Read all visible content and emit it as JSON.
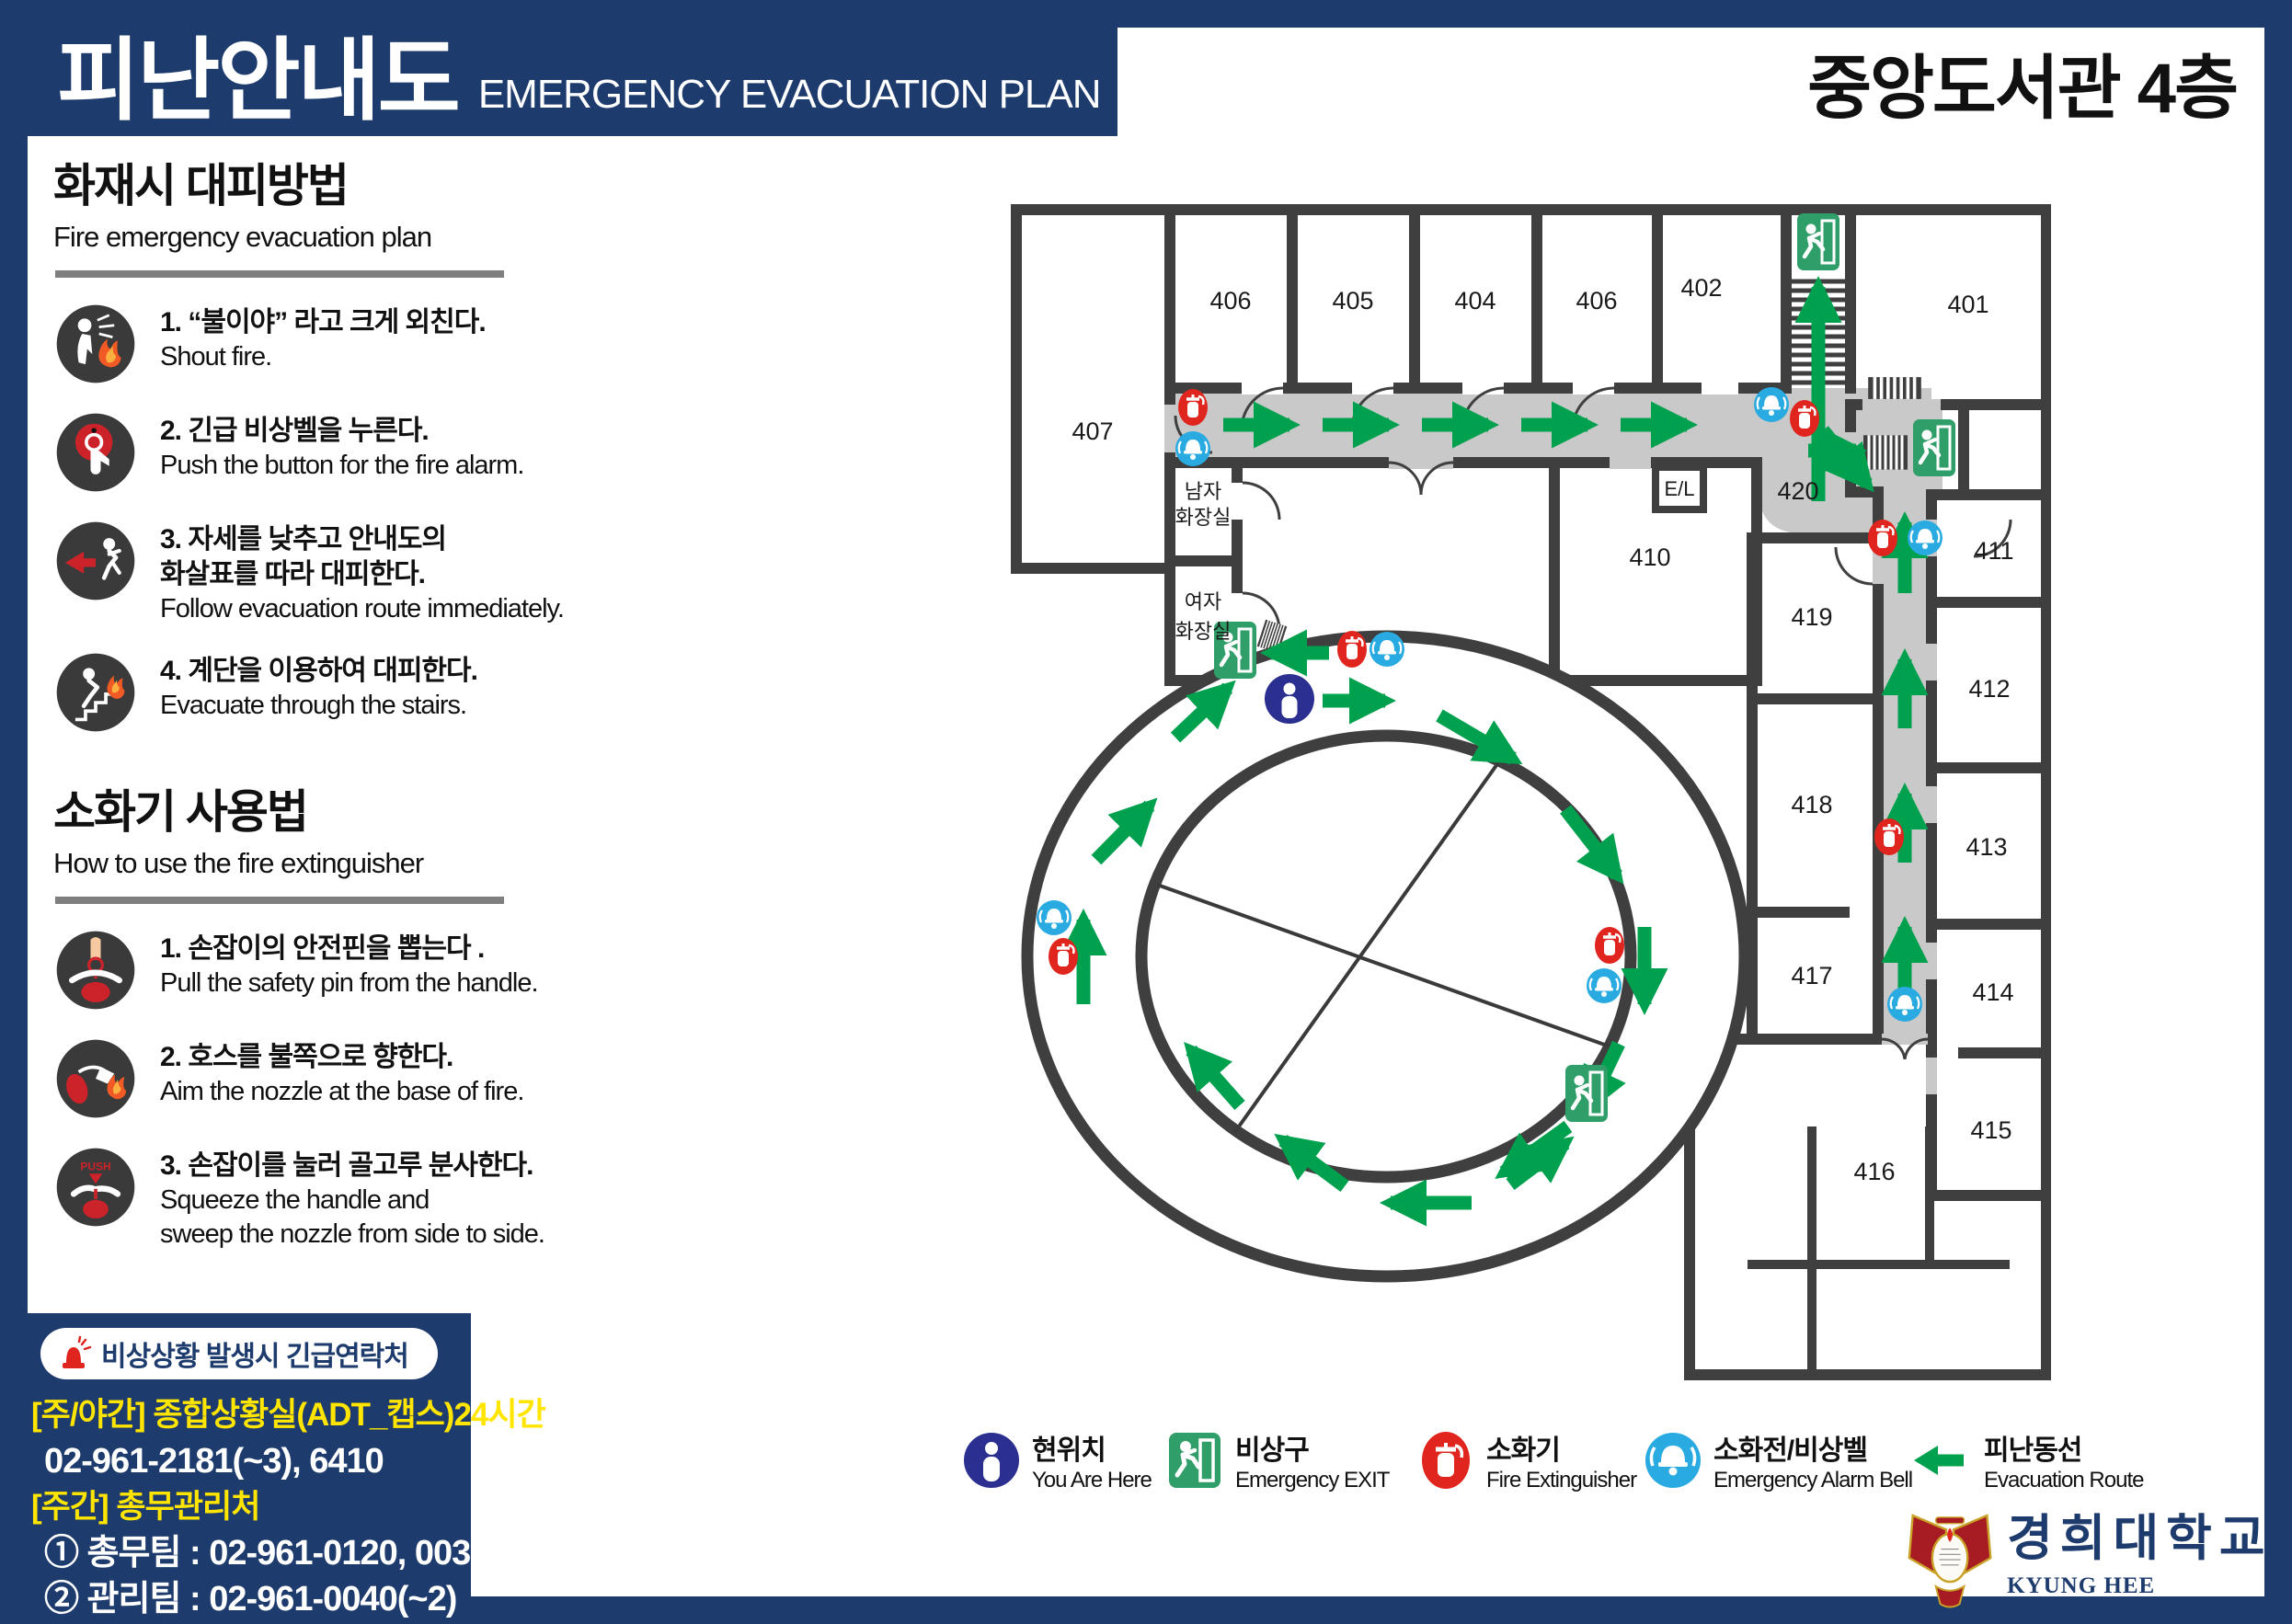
{
  "header": {
    "title_ko": "피난안내도",
    "title_en": "EMERGENCY EVACUATION PLAN",
    "location_title": "중앙도서관 4층"
  },
  "sidebar": {
    "fire": {
      "title_ko": "화재시 대피방법",
      "title_en": "Fire emergency evacuation plan",
      "steps": [
        {
          "icon": "shout-fire-icon",
          "ko_lines": [
            "1. “불이야” 라고 크게 외친다."
          ],
          "en_lines": [
            "Shout fire."
          ]
        },
        {
          "icon": "alarm-button-icon",
          "ko_lines": [
            "2. 긴급 비상벨을 누른다."
          ],
          "en_lines": [
            "Push the button for the fire alarm."
          ]
        },
        {
          "icon": "follow-route-icon",
          "ko_lines": [
            "3. 자세를 낮추고 안내도의",
            "화살표를 따라 대피한다."
          ],
          "en_lines": [
            "Follow evacuation route immediately."
          ]
        },
        {
          "icon": "stairs-evacuation-icon",
          "ko_lines": [
            "4. 계단을 이용하여 대피한다."
          ],
          "en_lines": [
            "Evacuate through the stairs."
          ]
        }
      ]
    },
    "extinguisher": {
      "title_ko": "소화기 사용법",
      "title_en": "How to use the fire extinguisher",
      "steps": [
        {
          "icon": "pull-pin-icon",
          "ko_lines": [
            "1. 손잡이의 안전핀을 뽑는다 ."
          ],
          "en_lines": [
            "Pull the safety pin from the handle."
          ]
        },
        {
          "icon": "aim-nozzle-icon",
          "ko_lines": [
            "2. 호스를 불쪽으로 향한다."
          ],
          "en_lines": [
            "Aim the nozzle at the base of fire."
          ]
        },
        {
          "icon": "squeeze-handle-icon",
          "ko_lines": [
            "3. 손잡이를 눌러 골고루 분사한다."
          ],
          "en_lines": [
            "Squeeze the handle and",
            "sweep the nozzle from side to side."
          ]
        }
      ]
    }
  },
  "contact": {
    "title": "비상상황 발생시 긴급연락처",
    "lines": [
      {
        "text": "[주/야간] 종합상황실(ADT_캡스)24시간",
        "emphasis": true
      },
      {
        "text": "02-961-2181(~3), 6410",
        "emphasis": false
      },
      {
        "text": "[주간] 총무관리처",
        "emphasis": true
      },
      {
        "text": "① 총무팀 : 02-961-0120, 0035",
        "emphasis": false
      },
      {
        "text": "② 관리팀 : 02-961-0040(~2)",
        "emphasis": false
      },
      {
        "text": "③ 안전팀 : 02-961-0119",
        "emphasis": false
      }
    ]
  },
  "floor_plan": {
    "rooms": [
      "407",
      "406",
      "405",
      "404",
      "406",
      "402",
      "401",
      "410",
      "420",
      "411",
      "412",
      "413",
      "414",
      "415",
      "416",
      "417",
      "418",
      "419"
    ],
    "labels": {
      "men_restroom": [
        "남자",
        "화장실"
      ],
      "women_restroom": [
        "여자",
        "화장실"
      ],
      "elevator": "E/L"
    }
  },
  "legend": {
    "items": [
      {
        "ko": "현위치",
        "en": "You Are Here",
        "icon": "you-are-here-icon"
      },
      {
        "ko": "비상구",
        "en": "Emergency EXIT",
        "icon": "emergency-exit-icon"
      },
      {
        "ko": "소화기",
        "en": "Fire Extinguisher",
        "icon": "fire-extinguisher-icon"
      },
      {
        "ko": "소화전/비상벨",
        "en": "Emergency Alarm Bell",
        "icon": "alarm-bell-icon"
      },
      {
        "ko": "피난동선",
        "en": "Evacuation Route",
        "icon": "evacuation-route-arrow"
      }
    ]
  },
  "university": {
    "name_ko": "경희대학교",
    "name_en": "KYUNG HEE UNIVERSITY"
  },
  "colors": {
    "navy": "#1d3b6d",
    "arrow_green": "#00a14e",
    "exit_green": "#2f9e68",
    "extinguisher_red": "#e0251f",
    "bell_blue": "#29abe2",
    "you_are_here_navy": "#2b2f90",
    "wall_gray": "#3f3f3f",
    "corridor_gray": "#c9c9c9",
    "highlight_yellow": "#ffe500"
  }
}
